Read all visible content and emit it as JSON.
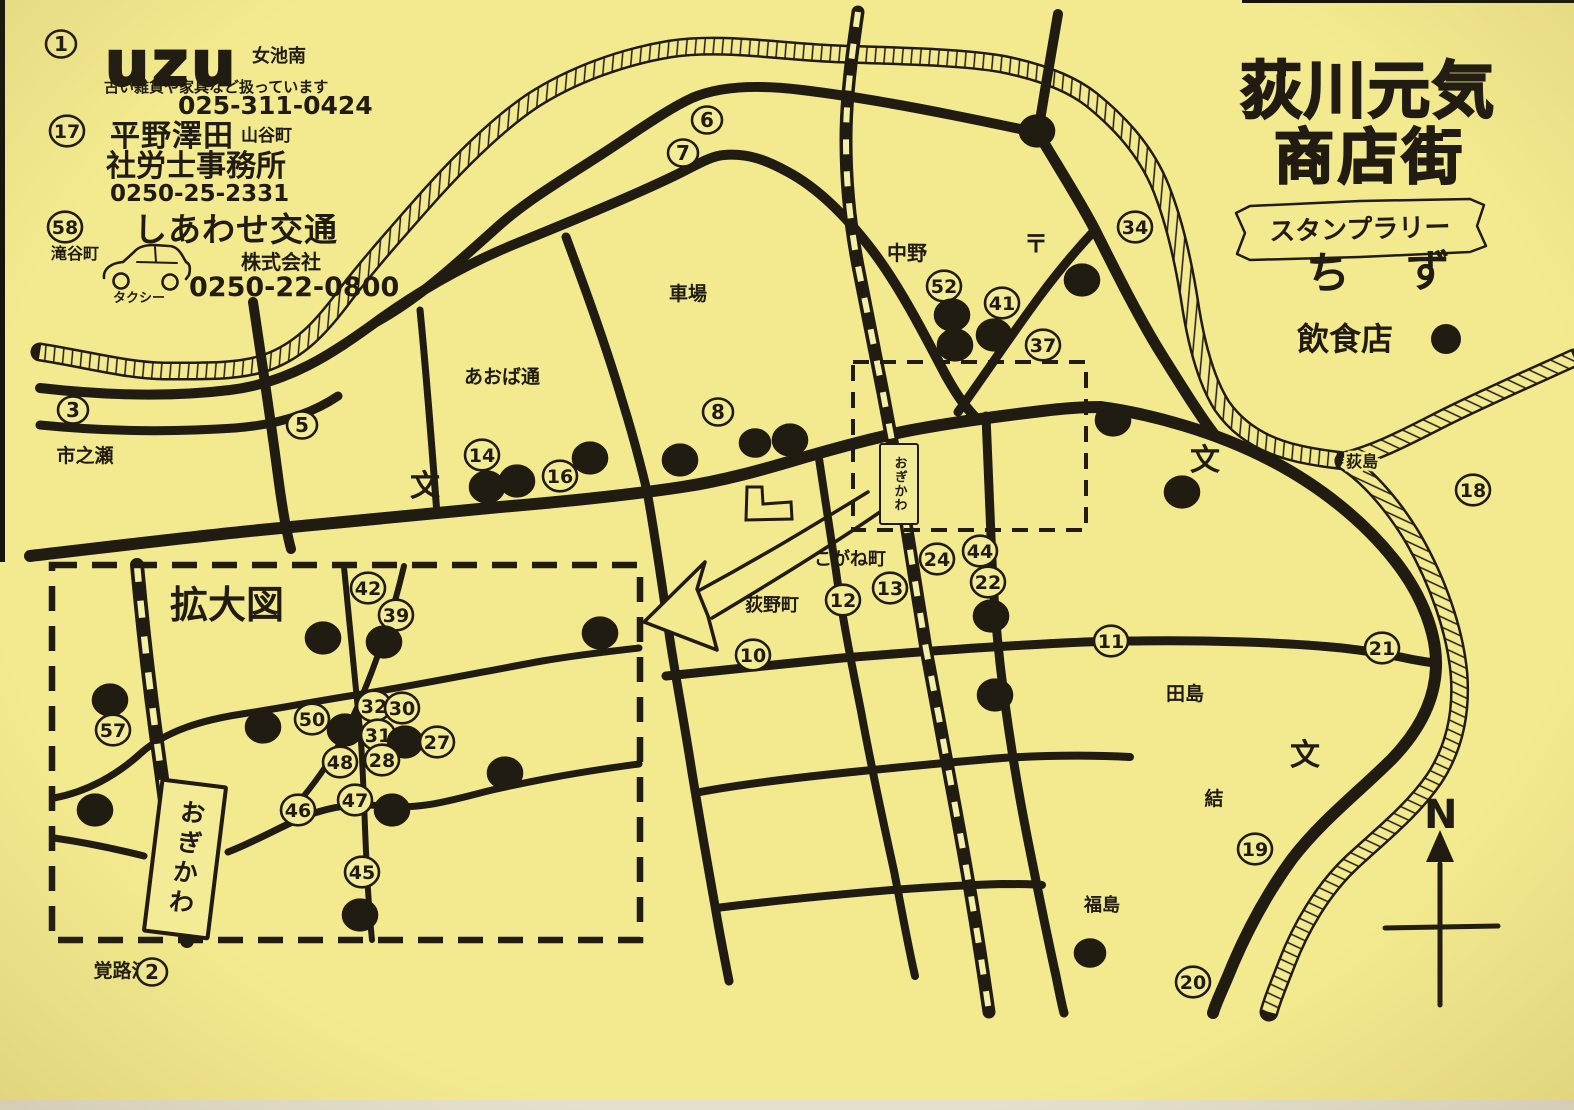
{
  "title": {
    "line1": "荻川元気",
    "line2": "商店街",
    "ribbon": "スタンプラリー",
    "subtitle_char1": "ち",
    "subtitle_char2": "ず"
  },
  "legend": {
    "label": "飲食店"
  },
  "ads": {
    "uzu": {
      "number": "1",
      "logo": "uzu",
      "area": "女池南",
      "desc": "古い雑貨や家具など扱っています",
      "phone": "025-311-0424"
    },
    "hirano": {
      "number": "17",
      "name1": "平野澤田",
      "name2": "社労士事務所",
      "area": "山谷町",
      "phone": "0250-25-2331"
    },
    "shiawase": {
      "number": "58",
      "name": "しあわせ交通",
      "company": "株式会社",
      "area": "滝谷町",
      "vehicle": "タクシー",
      "phone": "0250-22-0800"
    }
  },
  "map": {
    "station_name": "おぎかわ",
    "enlarged_label": "拡大図",
    "compass_letter": "N",
    "post_office_symbol": "〒",
    "school_symbol": "文",
    "places": [
      {
        "label": "市之瀬",
        "x": 85,
        "y": 462,
        "fs": 19
      },
      {
        "label": "あおば通",
        "x": 502,
        "y": 383,
        "fs": 19
      },
      {
        "label": "車場",
        "x": 688,
        "y": 300,
        "fs": 19
      },
      {
        "label": "中野",
        "x": 907,
        "y": 260,
        "fs": 20
      },
      {
        "label": "こがね町",
        "x": 850,
        "y": 565,
        "fs": 18
      },
      {
        "label": "荻野町",
        "x": 772,
        "y": 611,
        "fs": 18
      },
      {
        "label": "田島",
        "x": 1185,
        "y": 700,
        "fs": 19
      },
      {
        "label": "結",
        "x": 1214,
        "y": 805,
        "fs": 19
      },
      {
        "label": "福島",
        "x": 1102,
        "y": 911,
        "fs": 18
      },
      {
        "label": "覚路津",
        "x": 122,
        "y": 977,
        "fs": 19
      },
      {
        "label": "荻島",
        "x": 1362,
        "y": 467,
        "fs": 16,
        "halo": true
      }
    ],
    "schools": [
      {
        "x": 425,
        "y": 496
      },
      {
        "x": 1205,
        "y": 470
      },
      {
        "x": 1305,
        "y": 765
      }
    ],
    "stamps": [
      {
        "n": 1,
        "x": 61,
        "y": 44,
        "f": false
      },
      {
        "n": 17,
        "x": 67,
        "y": 131,
        "f": false
      },
      {
        "n": 58,
        "x": 65,
        "y": 227,
        "f": false
      },
      {
        "n": 3,
        "x": 73,
        "y": 410,
        "f": false
      },
      {
        "n": 5,
        "x": 302,
        "y": 425,
        "f": false
      },
      {
        "n": 6,
        "x": 707,
        "y": 120,
        "f": false
      },
      {
        "n": 7,
        "x": 683,
        "y": 153,
        "f": false
      },
      {
        "n": 40,
        "x": 1037,
        "y": 131,
        "f": true
      },
      {
        "n": 34,
        "x": 1135,
        "y": 227,
        "f": false
      },
      {
        "n": 35,
        "x": 1082,
        "y": 280,
        "f": true
      },
      {
        "n": 52,
        "x": 944,
        "y": 286,
        "f": false
      },
      {
        "n": 41,
        "x": 1002,
        "y": 303,
        "f": false
      },
      {
        "n": 54,
        "x": 952,
        "y": 315,
        "f": true
      },
      {
        "n": 65,
        "x": 994,
        "y": 335,
        "f": true
      },
      {
        "n": 53,
        "x": 955,
        "y": 345,
        "f": true
      },
      {
        "n": 37,
        "x": 1043,
        "y": 345,
        "f": false
      },
      {
        "n": 33,
        "x": 1113,
        "y": 420,
        "f": true
      },
      {
        "n": 25,
        "x": 1182,
        "y": 492,
        "f": true
      },
      {
        "n": 18,
        "x": 1473,
        "y": 490,
        "f": false
      },
      {
        "n": 8,
        "x": 718,
        "y": 412,
        "f": false
      },
      {
        "n": 14,
        "x": 482,
        "y": 455,
        "f": false
      },
      {
        "n": 15,
        "x": 590,
        "y": 458,
        "f": true
      },
      {
        "n": 16,
        "x": 560,
        "y": 476,
        "f": false
      },
      {
        "n": 62,
        "x": 487,
        "y": 487,
        "f": true
      },
      {
        "n": 63,
        "x": 517,
        "y": 481,
        "f": true
      },
      {
        "n": 60,
        "x": 680,
        "y": 460,
        "f": true
      },
      {
        "n": 9,
        "x": 755,
        "y": 443,
        "f": true
      },
      {
        "n": 59,
        "x": 790,
        "y": 440,
        "f": true
      },
      {
        "n": 24,
        "x": 937,
        "y": 559,
        "f": false
      },
      {
        "n": 44,
        "x": 980,
        "y": 551,
        "f": false
      },
      {
        "n": 22,
        "x": 988,
        "y": 582,
        "f": false
      },
      {
        "n": 23,
        "x": 991,
        "y": 616,
        "f": true
      },
      {
        "n": 13,
        "x": 890,
        "y": 588,
        "f": false
      },
      {
        "n": 12,
        "x": 843,
        "y": 600,
        "f": false
      },
      {
        "n": 10,
        "x": 753,
        "y": 655,
        "f": false
      },
      {
        "n": 11,
        "x": 1111,
        "y": 641,
        "f": false
      },
      {
        "n": 21,
        "x": 1382,
        "y": 648,
        "f": false
      },
      {
        "n": 61,
        "x": 995,
        "y": 695,
        "f": true
      },
      {
        "n": 19,
        "x": 1255,
        "y": 849,
        "f": false
      },
      {
        "n": 4,
        "x": 1090,
        "y": 953,
        "f": true
      },
      {
        "n": 20,
        "x": 1193,
        "y": 982,
        "f": false
      },
      {
        "n": 2,
        "x": 152,
        "y": 972,
        "f": false
      },
      {
        "n": 42,
        "x": 368,
        "y": 588,
        "f": false
      },
      {
        "n": 39,
        "x": 396,
        "y": 615,
        "f": false
      },
      {
        "n": 51,
        "x": 323,
        "y": 638,
        "f": true
      },
      {
        "n": 38,
        "x": 384,
        "y": 642,
        "f": true
      },
      {
        "n": 36,
        "x": 600,
        "y": 633,
        "f": true
      },
      {
        "n": 56,
        "x": 110,
        "y": 700,
        "f": true
      },
      {
        "n": 57,
        "x": 113,
        "y": 730,
        "f": false
      },
      {
        "n": 66,
        "x": 263,
        "y": 727,
        "f": true
      },
      {
        "n": 50,
        "x": 312,
        "y": 719,
        "f": false
      },
      {
        "n": 49,
        "x": 345,
        "y": 730,
        "f": true
      },
      {
        "n": 32,
        "x": 374,
        "y": 706,
        "f": false
      },
      {
        "n": 30,
        "x": 402,
        "y": 708,
        "f": false
      },
      {
        "n": 31,
        "x": 378,
        "y": 735,
        "f": false
      },
      {
        "n": 29,
        "x": 405,
        "y": 742,
        "f": true
      },
      {
        "n": 27,
        "x": 437,
        "y": 742,
        "f": false
      },
      {
        "n": 28,
        "x": 382,
        "y": 760,
        "f": false
      },
      {
        "n": 48,
        "x": 340,
        "y": 762,
        "f": false
      },
      {
        "n": 64,
        "x": 505,
        "y": 773,
        "f": true
      },
      {
        "n": 46,
        "x": 298,
        "y": 810,
        "f": false
      },
      {
        "n": 47,
        "x": 355,
        "y": 800,
        "f": false
      },
      {
        "n": 26,
        "x": 392,
        "y": 810,
        "f": true
      },
      {
        "n": 45,
        "x": 362,
        "y": 872,
        "f": false
      },
      {
        "n": 43,
        "x": 360,
        "y": 915,
        "f": true
      },
      {
        "n": 55,
        "x": 95,
        "y": 810,
        "f": true
      }
    ]
  }
}
